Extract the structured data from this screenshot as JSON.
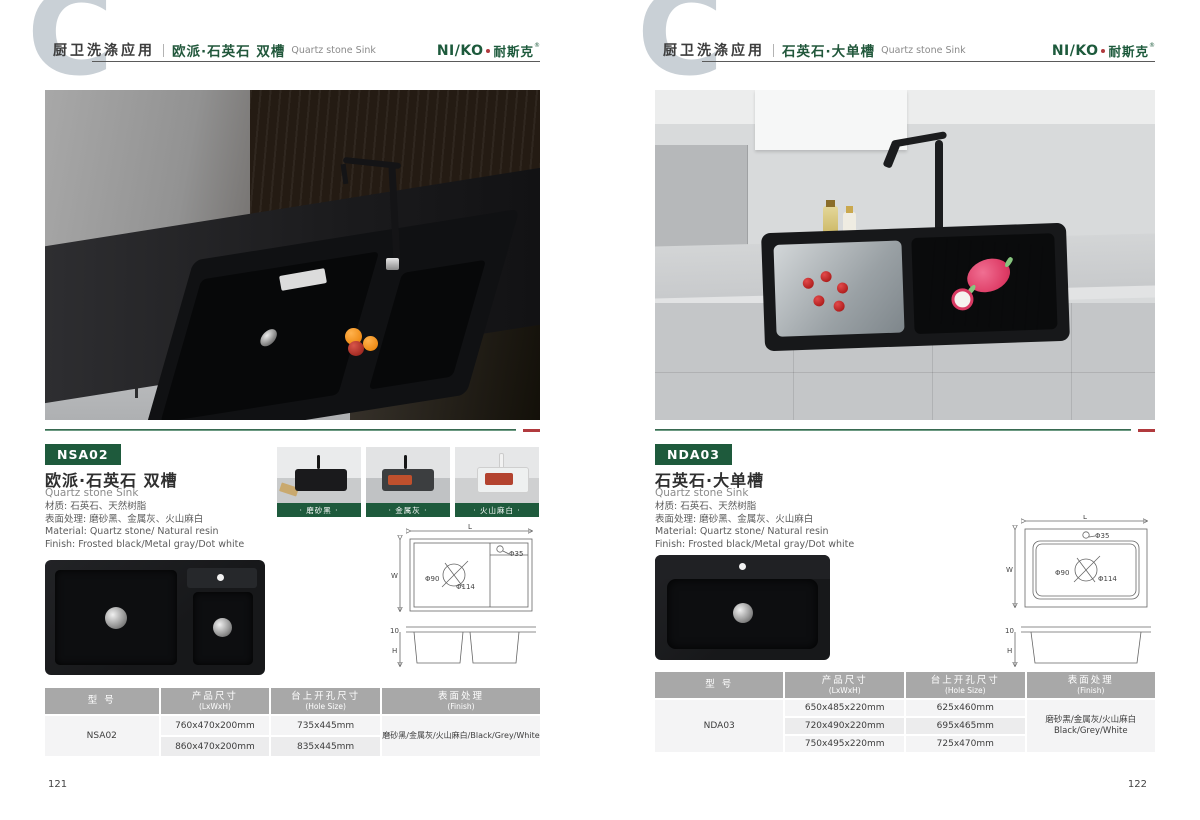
{
  "brand": {
    "logo_latin": "NI/KO",
    "logo_cn": "耐斯克",
    "reg_mark": "®"
  },
  "colors": {
    "brand_green": "#1E5A3C",
    "accent_red": "#B13A3E",
    "watermark_gray": "#C9D0D6",
    "table_header_gray": "#A8A8A8"
  },
  "pages": [
    {
      "page_number": "121",
      "header": {
        "section": "厨卫洗涤应用",
        "category_cn": "欧派·石英石 双槽",
        "category_en": "Quartz stone Sink"
      },
      "product": {
        "model": "NSA02",
        "title_cn": "欧派·石英石 双槽",
        "title_en": "Quartz stone Sink",
        "material_cn": "材质: 石英石、天然树脂",
        "finish_cn": "表面处理: 磨砂黑、金属灰、火山麻白",
        "material_en": "Material: Quartz stone/ Natural resin",
        "finish_en": "Finish: Frosted black/Metal gray/Dot white"
      },
      "swatches": [
        {
          "label": "· 磨砂黑 ·"
        },
        {
          "label": "· 金属灰 ·"
        },
        {
          "label": "· 火山麻白 ·"
        }
      ],
      "diagram": {
        "l": "L",
        "w": "W",
        "d35": "Φ35",
        "d90": "Φ90",
        "d114": "Φ114",
        "edge": "10",
        "h": "H"
      },
      "table": {
        "headers": [
          {
            "cn": "型 号",
            "en": ""
          },
          {
            "cn": "产品尺寸",
            "en": "(LxWxH)"
          },
          {
            "cn": "台上开孔尺寸",
            "en": "(Hole Size)"
          },
          {
            "cn": "表面处理",
            "en": "(Finish)"
          }
        ],
        "model": "NSA02",
        "sizes": [
          "760x470x200mm",
          "860x470x200mm"
        ],
        "holes": [
          "735x445mm",
          "835x445mm"
        ],
        "finish_line1": "磨砂黑/金属灰/火山麻白/Black/Grey/White",
        "finish_line2": ""
      }
    },
    {
      "page_number": "122",
      "header": {
        "section": "厨卫洗涤应用",
        "category_cn": "石英石·大单槽",
        "category_en": "Quartz stone Sink"
      },
      "product": {
        "model": "NDA03",
        "title_cn": "石英石·大单槽",
        "title_en": "Quartz stone Sink",
        "material_cn": "材质: 石英石、天然树脂",
        "finish_cn": "表面处理: 磨砂黑、金属灰、火山麻白",
        "material_en": "Material: Quartz stone/ Natural resin",
        "finish_en": "Finish: Frosted black/Metal gray/Dot white"
      },
      "diagram": {
        "l": "L",
        "w": "W",
        "d35": "Φ35",
        "d90": "Φ90",
        "d114": "Φ114",
        "edge": "10",
        "h": "H"
      },
      "table": {
        "headers": [
          {
            "cn": "型 号",
            "en": ""
          },
          {
            "cn": "产品尺寸",
            "en": "(LxWxH)"
          },
          {
            "cn": "台上开孔尺寸",
            "en": "(Hole Size)"
          },
          {
            "cn": "表面处理",
            "en": "(Finish)"
          }
        ],
        "model": "NDA03",
        "sizes": [
          "650x485x220mm",
          "720x490x220mm",
          "750x495x220mm"
        ],
        "holes": [
          "625x460mm",
          "695x465mm",
          "725x470mm"
        ],
        "finish_line1": "磨砂黑/金属灰/火山麻白",
        "finish_line2": "Black/Grey/White"
      }
    }
  ]
}
